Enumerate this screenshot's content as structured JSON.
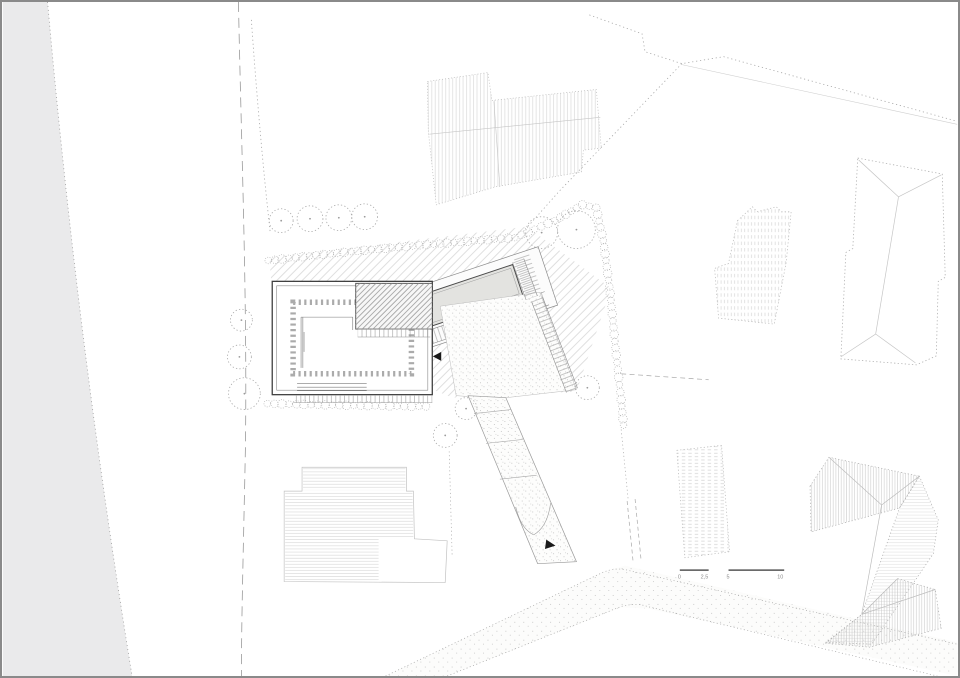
{
  "scale_bar": {
    "labels": [
      "0",
      "2,5",
      "5",
      "10"
    ]
  },
  "colors": {
    "paper": "#ffffff",
    "frame": "#8a8a8a",
    "ground_shade": "#eaeaeb",
    "hatch_light": "#d0d0d0",
    "hatch_dark": "#9b9b9b",
    "outline_light": "#b5b5b5",
    "outline_dark": "#3f3f3f",
    "pool_water": "#e3e3e0",
    "arrow": "#1a1a1a"
  },
  "drawing": {
    "trees": [
      {
        "cx": 280,
        "cy": 220,
        "r": 12
      },
      {
        "cx": 309,
        "cy": 218,
        "r": 13
      },
      {
        "cx": 338,
        "cy": 217,
        "r": 13
      },
      {
        "cx": 364,
        "cy": 216,
        "r": 13
      },
      {
        "cx": 240,
        "cy": 320,
        "r": 11
      },
      {
        "cx": 238,
        "cy": 357,
        "r": 12
      },
      {
        "cx": 243,
        "cy": 394,
        "r": 16
      },
      {
        "cx": 542,
        "cy": 232,
        "r": 16
      },
      {
        "cx": 577,
        "cy": 229,
        "r": 19
      },
      {
        "cx": 588,
        "cy": 388,
        "r": 12
      },
      {
        "cx": 466,
        "cy": 409,
        "r": 11
      },
      {
        "cx": 445,
        "cy": 436,
        "r": 12
      }
    ],
    "hedges": [
      {
        "r": 3.8,
        "spacing": 7,
        "points": [
          [
            267,
            260
          ],
          [
            350,
            251
          ],
          [
            440,
            243
          ],
          [
            515,
            237
          ],
          [
            555,
            220
          ],
          [
            583,
            204
          ],
          [
            597,
            207
          ],
          [
            604,
            240
          ],
          [
            611,
            293
          ],
          [
            617,
            355
          ],
          [
            622,
            400
          ],
          [
            625,
            432
          ]
        ]
      },
      {
        "r": 3.8,
        "spacing": 7,
        "points": [
          [
            266,
            404
          ],
          [
            310,
            405
          ],
          [
            360,
            406
          ],
          [
            433,
            407
          ]
        ]
      }
    ],
    "arrows": [
      {
        "points": "441,352 441,361 432.5,356.5",
        "rotate": ""
      },
      {
        "points": "546,541.5 546,551 556,546.2",
        "rotate": "8 551 546"
      }
    ]
  }
}
